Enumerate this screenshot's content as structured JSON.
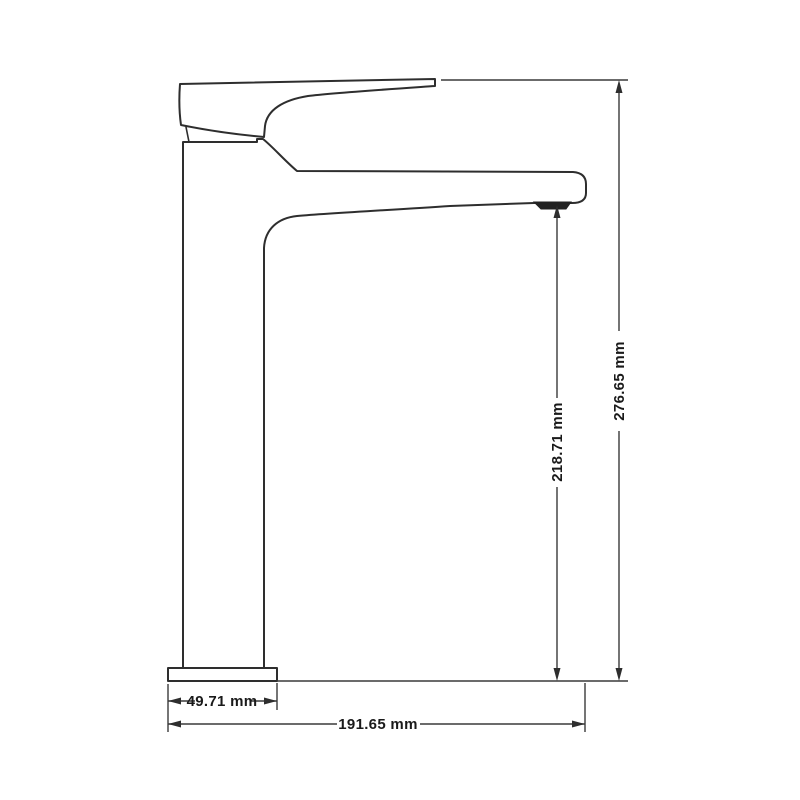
{
  "drawing": {
    "background_color": "#ffffff",
    "line_color": "#2e2e2e",
    "text_color": "#1a1a1a",
    "dimensions": {
      "base_width": {
        "label": "49.71 mm",
        "value": 49.71,
        "unit": "mm",
        "orientation": "horizontal"
      },
      "spout_reach": {
        "label": "191.65 mm",
        "value": 191.65,
        "unit": "mm",
        "orientation": "horizontal"
      },
      "outlet_height": {
        "label": "218.71 mm",
        "value": 218.71,
        "unit": "mm",
        "orientation": "vertical"
      },
      "overall_height": {
        "label": "276.65 mm",
        "value": 276.65,
        "unit": "mm",
        "orientation": "vertical"
      }
    }
  }
}
